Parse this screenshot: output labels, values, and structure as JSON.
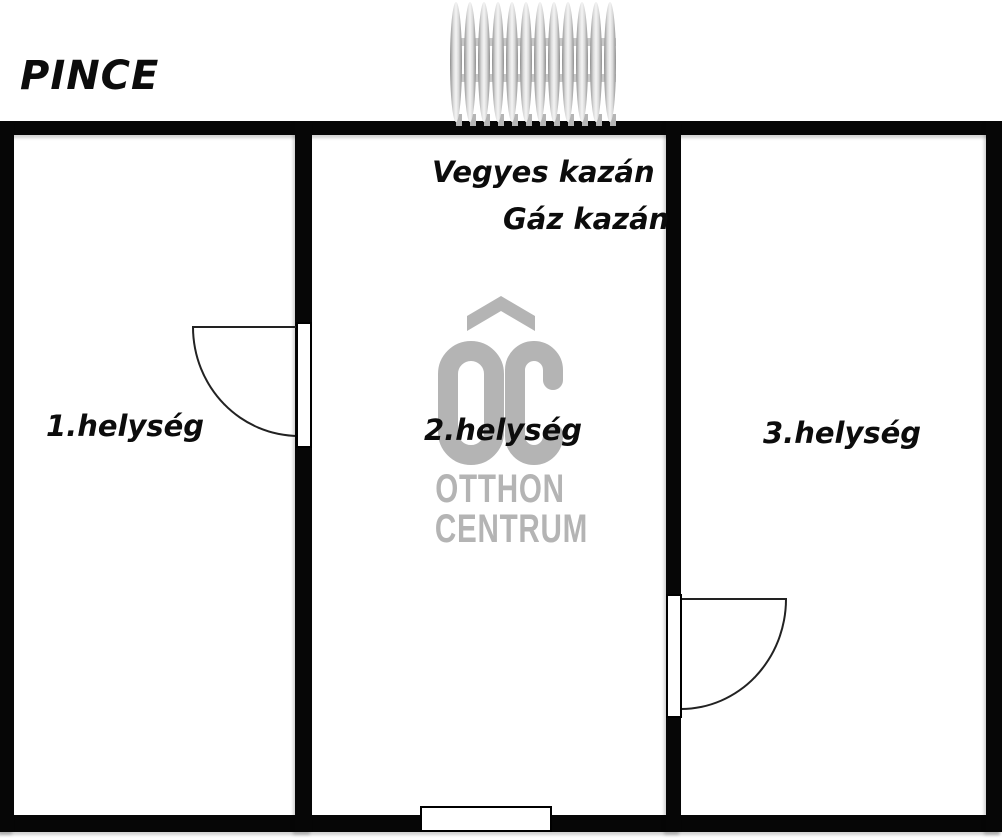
{
  "plan": {
    "title": "PINCE",
    "rooms": [
      {
        "label": "1.helység"
      },
      {
        "label": "2.helység"
      },
      {
        "label": "3.helység"
      }
    ],
    "boilers": [
      {
        "label": "Vegyes kazán"
      },
      {
        "label": "Gáz kazán"
      }
    ],
    "radiator": {
      "fin_count": 12
    }
  },
  "watermark": {
    "monogram": "OC",
    "line1": "OTTHON",
    "line2": "CENTRUM"
  },
  "colors": {
    "wall": "#060606",
    "line": "#222222",
    "text": "#0c0c0c",
    "watermark": "#b4b4b4",
    "radiator-edge": "#8f8f8f",
    "radiator-light": "#f4f4f4"
  }
}
